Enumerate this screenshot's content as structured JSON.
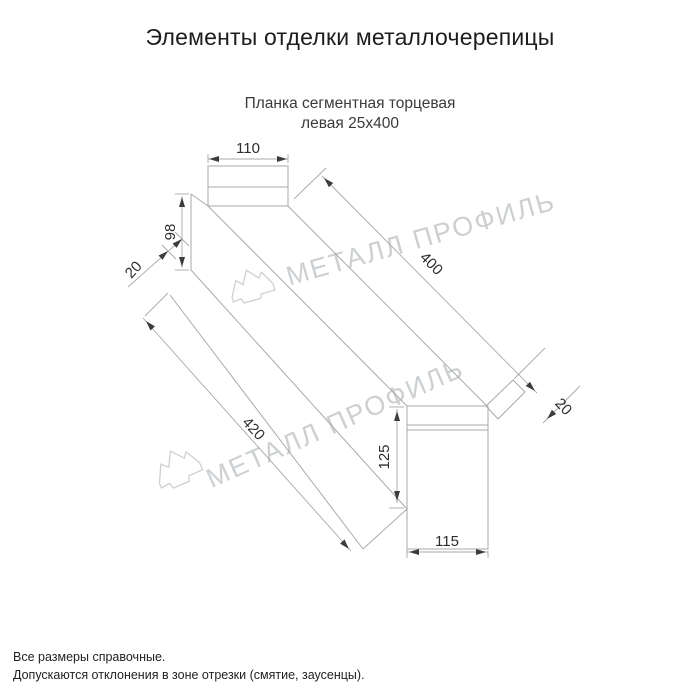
{
  "page": {
    "title": "Элементы отделки металлочерепицы"
  },
  "drawing": {
    "subtitle_line1": "Планка сегментная торцевая",
    "subtitle_line2": "левая 25х400",
    "watermark_text": "МЕТАЛЛ ПРОФИЛЬ",
    "dims": {
      "cap_width": "110",
      "left_end_height": "98",
      "left_fold": "20",
      "length": "400",
      "right_fold": "20",
      "total_length": "420",
      "end_height": "125",
      "end_width": "115"
    },
    "colors": {
      "line": "#a7a9ab",
      "dimension_text": "#2e2e2e",
      "watermark": "#cdd0d2"
    }
  },
  "footer": {
    "note1": "Все размеры справочные.",
    "note2": "Допускаются отклонения в зоне отрезки (смятие, заусенцы)."
  }
}
